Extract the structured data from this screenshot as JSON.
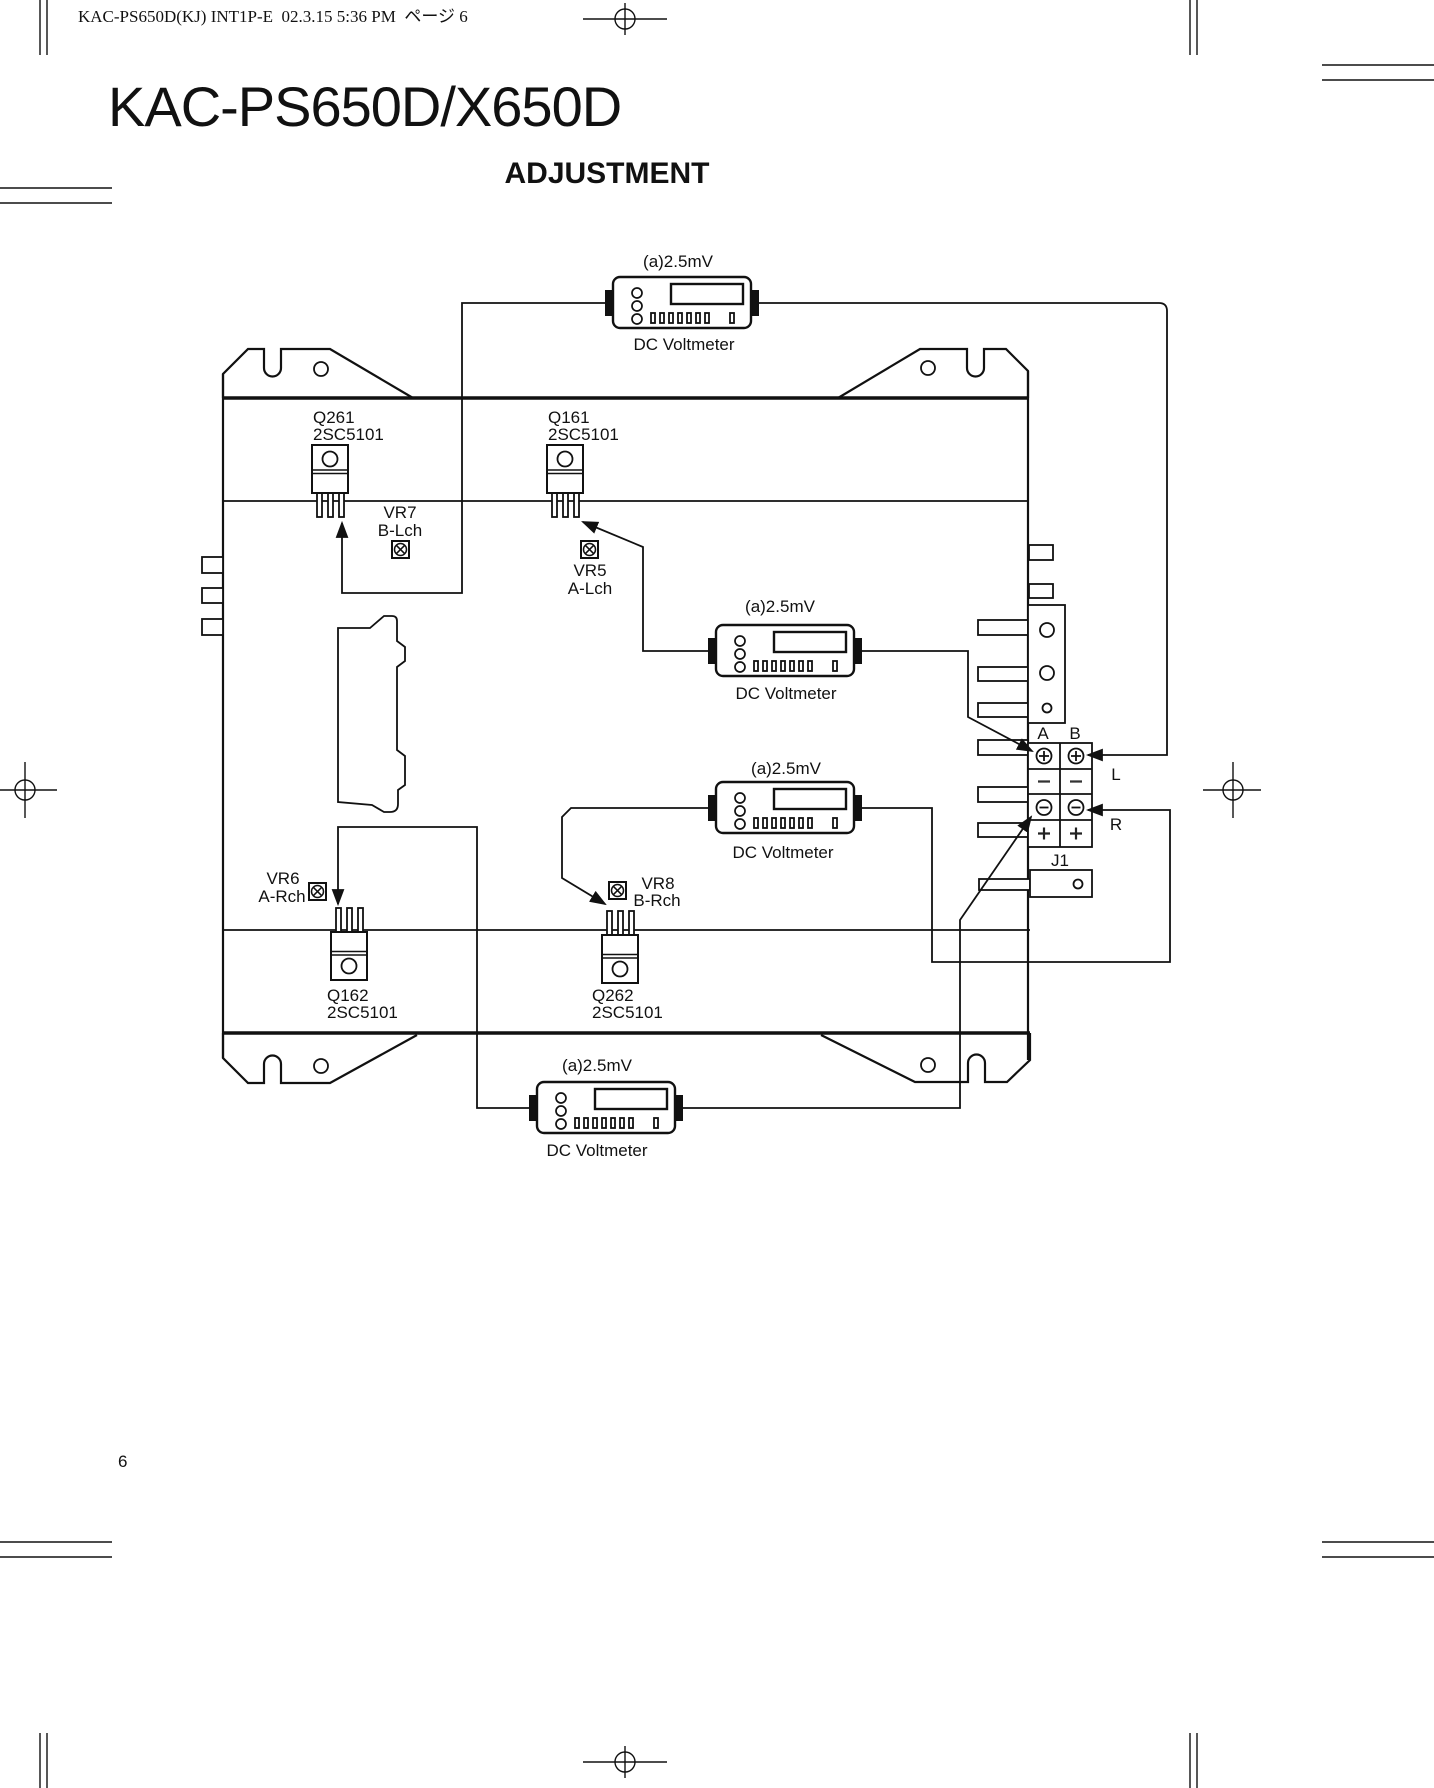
{
  "header": {
    "print_info": "KAC-PS650D(KJ) INT1P-E  02.3.15 5:36 PM  ページ 6"
  },
  "title": "KAC-PS650D/X650D",
  "subtitle": "ADJUSTMENT",
  "page_number": "6",
  "diagram": {
    "voltmeters": [
      {
        "test_point": "(a)2.5mV",
        "label": "DC Voltmeter"
      },
      {
        "test_point": "(a)2.5mV",
        "label": "DC Voltmeter"
      },
      {
        "test_point": "(a)2.5mV",
        "label": "DC Voltmeter"
      },
      {
        "test_point": "(a)2.5mV",
        "label": "DC Voltmeter"
      }
    ],
    "transistors": [
      {
        "ref": "Q261",
        "part": "2SC5101"
      },
      {
        "ref": "Q161",
        "part": "2SC5101"
      },
      {
        "ref": "Q162",
        "part": "2SC5101"
      },
      {
        "ref": "Q262",
        "part": "2SC5101"
      }
    ],
    "trimmers": [
      {
        "ref": "VR7",
        "channel": "B-Lch"
      },
      {
        "ref": "VR5",
        "channel": "A-Lch"
      },
      {
        "ref": "VR6",
        "channel": "A-Rch"
      },
      {
        "ref": "VR8",
        "channel": "B-Rch"
      }
    ],
    "terminals": {
      "col_a": "A",
      "col_b": "B",
      "rows": [
        "⊕",
        "−",
        "⊖",
        "+"
      ],
      "left_channel": "L",
      "right_channel": "R",
      "connector": "J1"
    }
  }
}
